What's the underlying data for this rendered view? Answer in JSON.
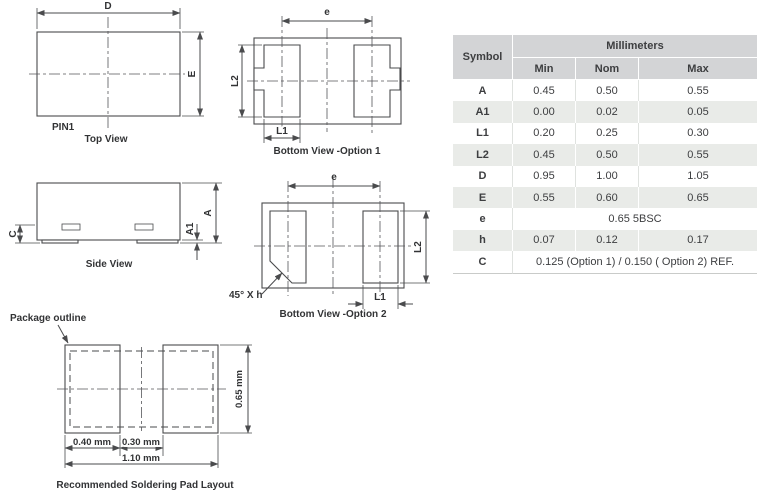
{
  "colors": {
    "drawing_line": "#4a4b4d",
    "table_header_bg": "#d3d4d6",
    "table_shade_bg": "#e9ebe8",
    "table_text": "#3d3e40"
  },
  "views": {
    "top_view": {
      "caption": "Top View",
      "pin_label": "PIN1",
      "dim_width": "D",
      "dim_height": "E"
    },
    "bottom_view_option1": {
      "caption": "Bottom View -Option 1",
      "dim_pitch": "e",
      "dim_pad_width": "L1",
      "dim_pad_length": "L2"
    },
    "side_view": {
      "caption": "Side View",
      "dim_lead_thickness": "C",
      "dim_standoff": "A1",
      "dim_height": "A"
    },
    "bottom_view_option2": {
      "caption": "Bottom View -Option 2",
      "dim_pitch": "e",
      "dim_pad_width": "L1",
      "dim_pad_length": "L2",
      "chamfer_label": "45° X h"
    },
    "pad_layout": {
      "caption": "Recommended Soldering Pad Layout",
      "outline_label": "Package outline",
      "dim_pad_width": "0.40 mm",
      "dim_gap": "0.30 mm",
      "dim_total_width": "1.10 mm",
      "dim_pad_height": "0.65 mm"
    }
  },
  "table": {
    "symbol_header": "Symbol",
    "unit_header": "Millimeters",
    "columns": [
      "Min",
      "Nom",
      "Max"
    ],
    "rows": [
      {
        "symbol": "A",
        "min": "0.45",
        "nom": "0.50",
        "max": "0.55"
      },
      {
        "symbol": "A1",
        "min": "0.00",
        "nom": "0.02",
        "max": "0.05"
      },
      {
        "symbol": "L1",
        "min": "0.20",
        "nom": "0.25",
        "max": "0.30"
      },
      {
        "symbol": "L2",
        "min": "0.45",
        "nom": "0.50",
        "max": "0.55"
      },
      {
        "symbol": "D",
        "min": "0.95",
        "nom": "1.00",
        "max": "1.05"
      },
      {
        "symbol": "E",
        "min": "0.55",
        "nom": "0.60",
        "max": "0.65"
      },
      {
        "symbol": "e",
        "span": "0.65 5BSC"
      },
      {
        "symbol": "h",
        "min": "0.07",
        "nom": "0.12",
        "max": "0.17"
      },
      {
        "symbol": "C",
        "span": "0.125 (Option 1) / 0.150 ( Option 2) REF."
      }
    ]
  }
}
